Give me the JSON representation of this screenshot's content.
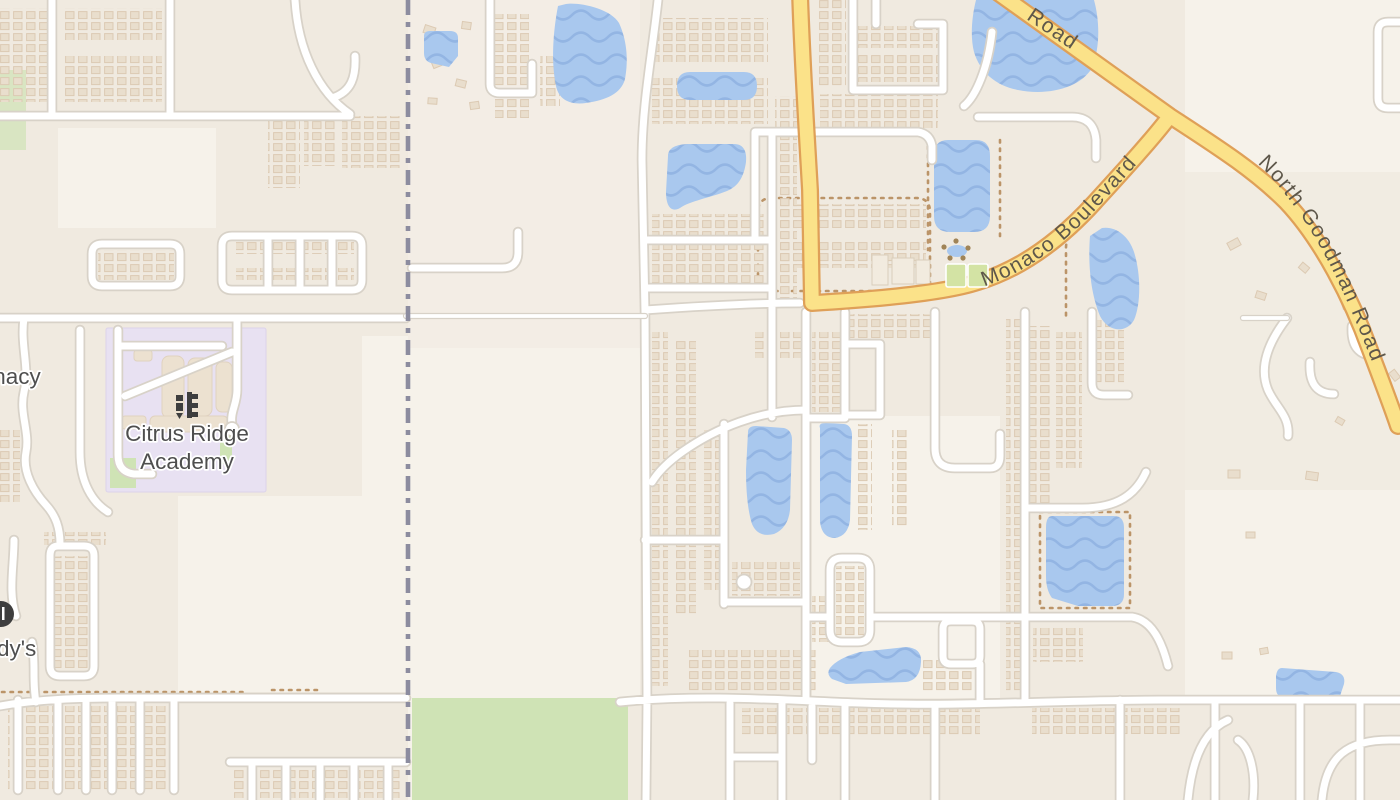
{
  "map": {
    "labels": {
      "school_line1": "Citrus Ridge",
      "school_line2": "Academy",
      "pharmacy_partial": "macy",
      "wendys_partial": "dy's",
      "road_top": "Road",
      "monaco": "Monaco Boulevard",
      "goodman": "North Goodman Road"
    },
    "colors": {
      "base": "#f6f2ea",
      "residential": "#f0eae0",
      "road_fill": "#ffffff",
      "road_casing": "#d8d2c8",
      "major_fill": "#fbe289",
      "major_casing": "#dfa058",
      "water": "#a9c8ee",
      "water_wave": "#93b5e3",
      "park": "#cfe3b5",
      "school": "#e8e1f2",
      "building": "#e9decd",
      "building_stroke": "#dccab3",
      "boundary": "#8c8c9f",
      "text": "#4e4e4e",
      "road_text": "#5e574a",
      "icon": "#3e3e3e",
      "trail": "#bb9468",
      "court": "#d3e3a4"
    }
  }
}
